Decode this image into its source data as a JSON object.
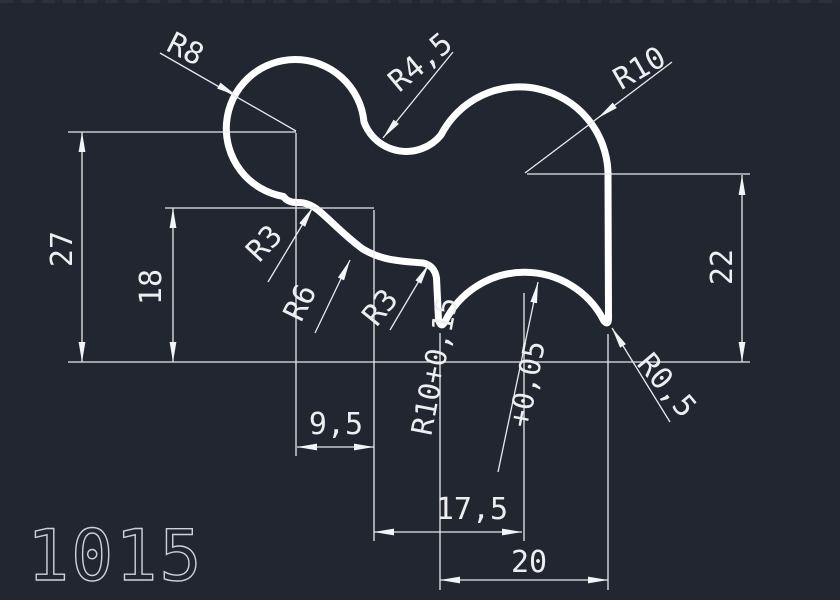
{
  "canvas": {
    "part_number": "1015",
    "background_color": "#212630",
    "geometry_color": "#ffffff",
    "dimension_color": "#e7eaed"
  },
  "labels": {
    "r8": "R8",
    "r4_5": "R4,5",
    "r10": "R10",
    "r3_upper": "R3",
    "r6": "R6",
    "r3_lower": "R3",
    "r10_tolerance_line1": "R10+0,15",
    "r10_tolerance_line2": "+0,05",
    "r0_5": "R0,5",
    "height_27": "27",
    "height_18": "18",
    "height_22": "22",
    "width_9_5": "9,5",
    "width_17_5": "17,5",
    "width_20": "20"
  }
}
